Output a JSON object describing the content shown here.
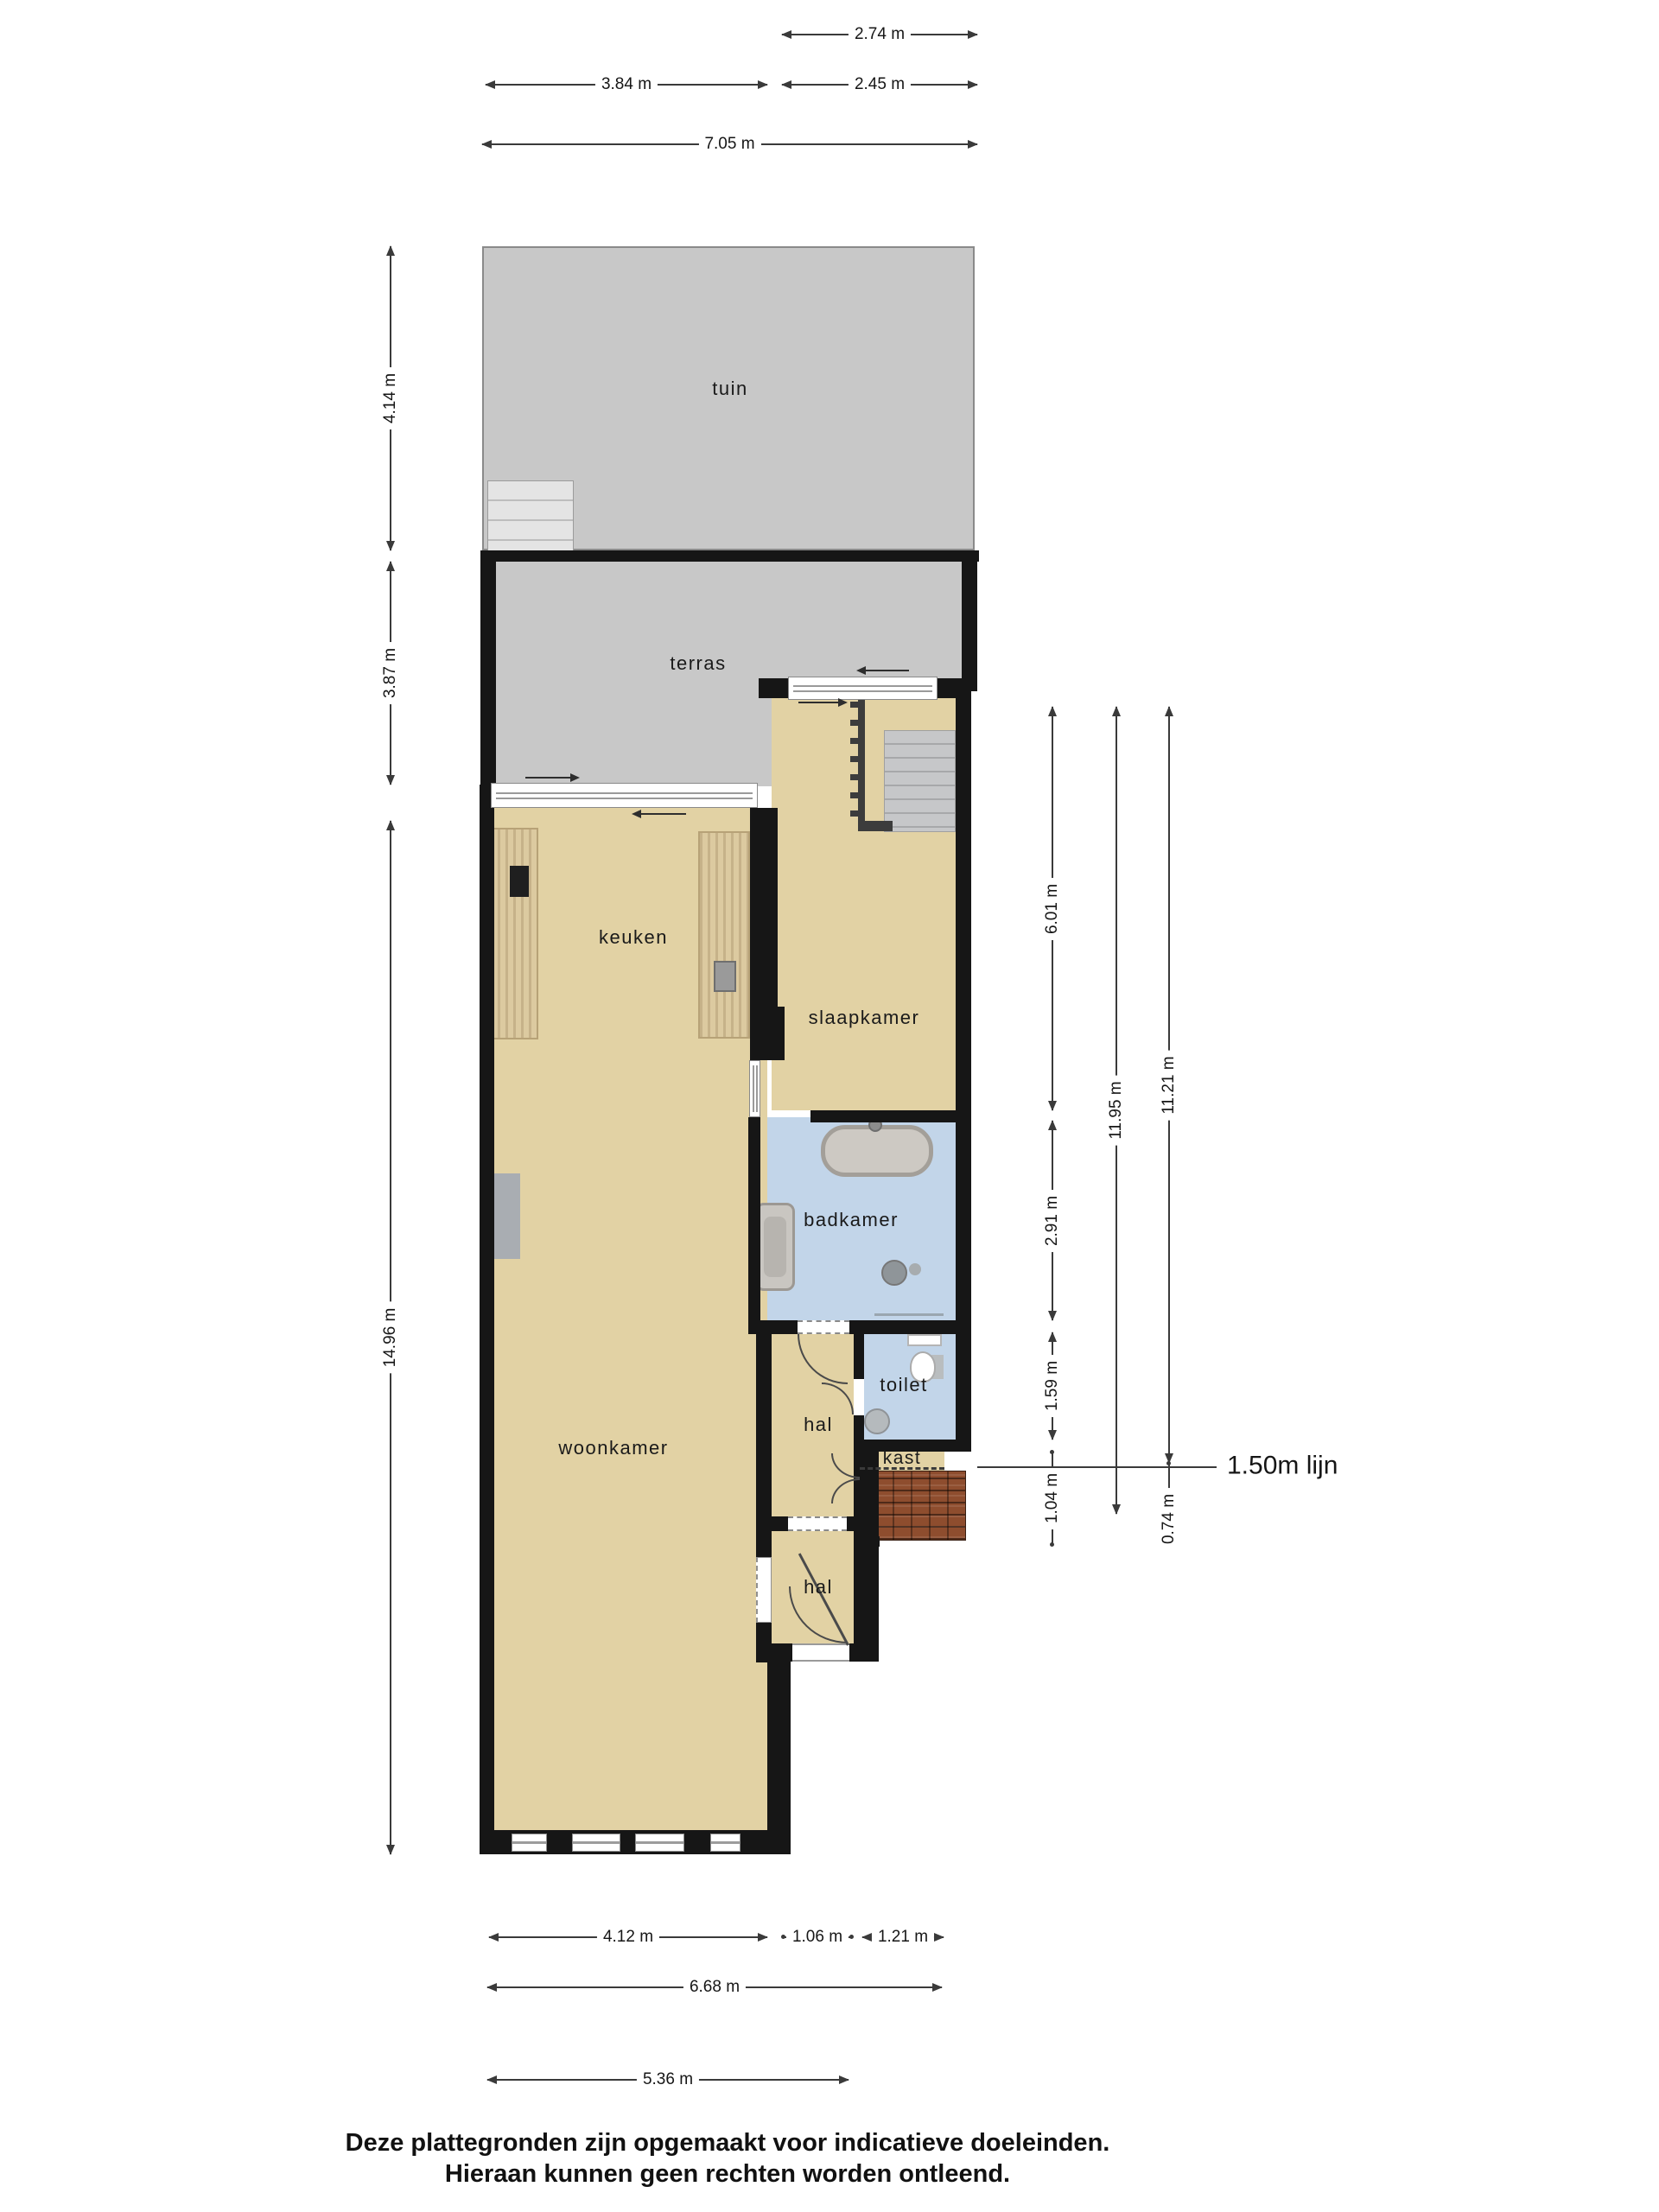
{
  "colors": {
    "wall": "#161616",
    "floor": "#e2d2a4",
    "wet": "#c2d5e9",
    "outdoor": "#c8c8c8",
    "wood": "#dccaa0",
    "brick": "#8e4d2e",
    "steps": "#e4e4e4",
    "stairs": "#c6c7c9",
    "line": "#3a3a3a"
  },
  "rooms": {
    "tuin": "tuin",
    "terras": "terras",
    "keuken": "keuken",
    "slaapkamer": "slaapkamer",
    "badkamer": "badkamer",
    "toilet": "toilet",
    "hal": "hal",
    "kast": "kast",
    "woonkamer": "woonkamer"
  },
  "dimensions": {
    "top": [
      "2.74 m",
      "3.84 m",
      "2.45 m",
      "7.05 m"
    ],
    "left": [
      "4.14 m",
      "3.87 m",
      "14.96 m"
    ],
    "right": [
      "6.01 m",
      "2.91 m",
      "1.59 m",
      "1.04 m",
      "11.95 m",
      "11.21 m",
      "0.74 m"
    ],
    "bottom": [
      "4.12 m",
      "1.06 m",
      "1.21 m",
      "6.68 m",
      "5.36 m"
    ],
    "annotation_150": "1.50m lijn"
  },
  "footer": {
    "line1": "Deze plattegronden zijn opgemaakt voor indicatieve doeleinden.",
    "line2": "Hieraan kunnen geen rechten worden ontleend."
  }
}
